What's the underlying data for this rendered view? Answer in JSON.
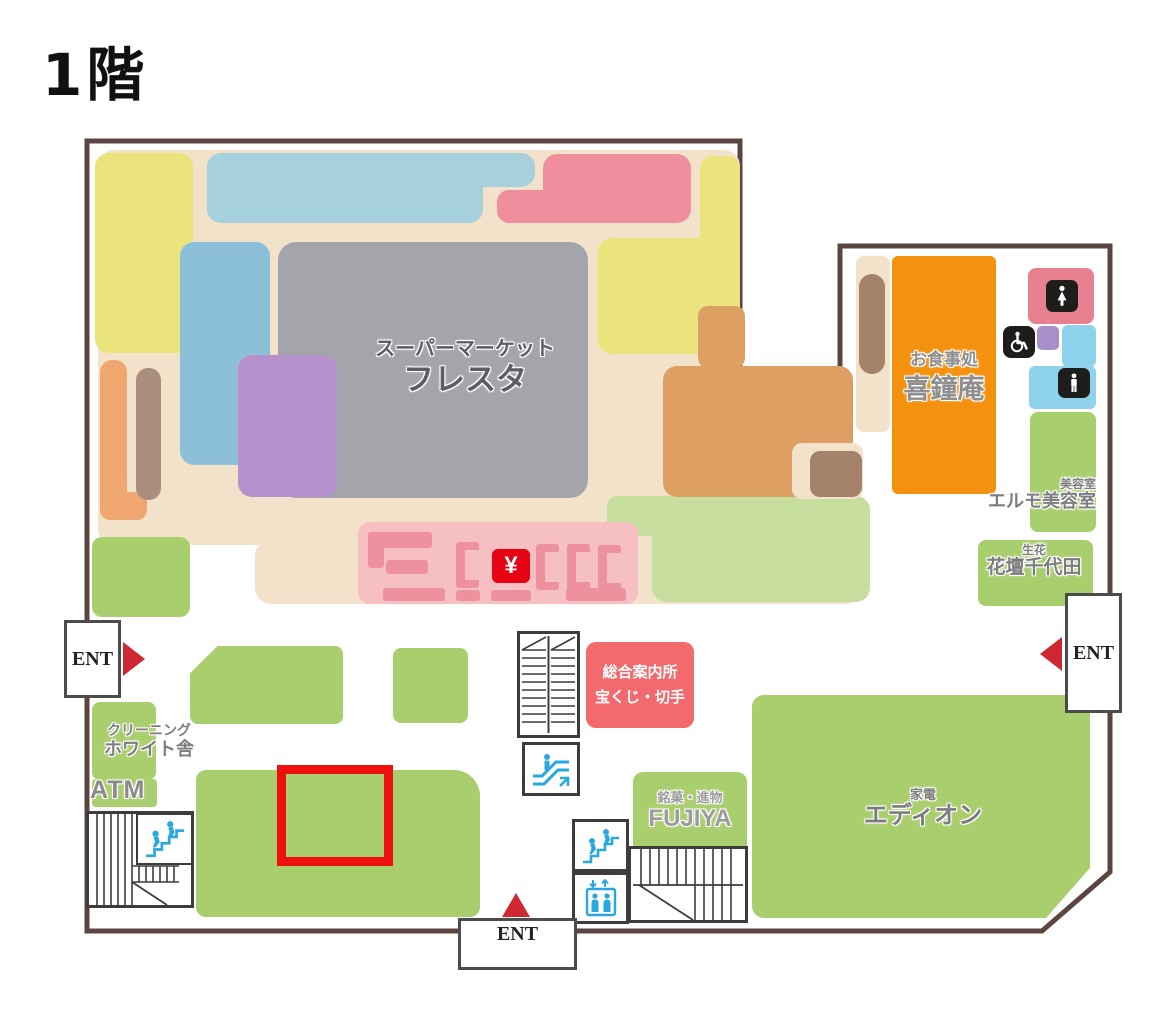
{
  "title": "1階",
  "areas": {
    "supermarket": {
      "category": "スーパーマーケット",
      "name": "フレスタ"
    },
    "restaurant": {
      "category": "お食事処",
      "name": "喜鐘庵"
    },
    "beauty_salon": {
      "category": "美容室",
      "name": "エルモ美容室"
    },
    "flower_shop": {
      "category": "生花",
      "name": "花壇千代田"
    },
    "information": {
      "line1": "総合案内所",
      "line2": "宝くじ・切手"
    },
    "cleaning": {
      "category": "クリーニング",
      "name": "ホワイト舎"
    },
    "atm": {
      "name": "ATM"
    },
    "confectionery": {
      "category": "銘菓・進物",
      "name": "FUJIYA"
    },
    "electronics": {
      "category": "家電",
      "name": "エディオン"
    }
  },
  "entrances": {
    "left": "ENT",
    "right": "ENT",
    "bottom": "ENT"
  },
  "symbols": {
    "yen": "¥"
  },
  "colors": {
    "outline": "#5a4540",
    "floor_tan": "#f3e2ca",
    "green": "#a9ce6d",
    "pale_green": "#c7de9f",
    "yellow": "#ebe37c",
    "light_blue": "#a6d0dc",
    "blue": "#8cc0d8",
    "gray": "#a4a4ab",
    "purple": "#b791cb",
    "pink": "#ef8f9d",
    "rose": "#e8808f",
    "sky_blue": "#8ed2ec",
    "orange": "#f4920f",
    "mid_orange": "#de9f63",
    "light_orange": "#efa76f",
    "brown": "#a5836b",
    "taupe": "#a98e7e",
    "checkout_bg": "#f6bfc2",
    "checkout_fg": "#ee919e",
    "yen_red": "#e60113",
    "info_red": "#f26a6e",
    "highlight_red": "#ee0f0f",
    "icon_blue": "#29a8e0"
  }
}
